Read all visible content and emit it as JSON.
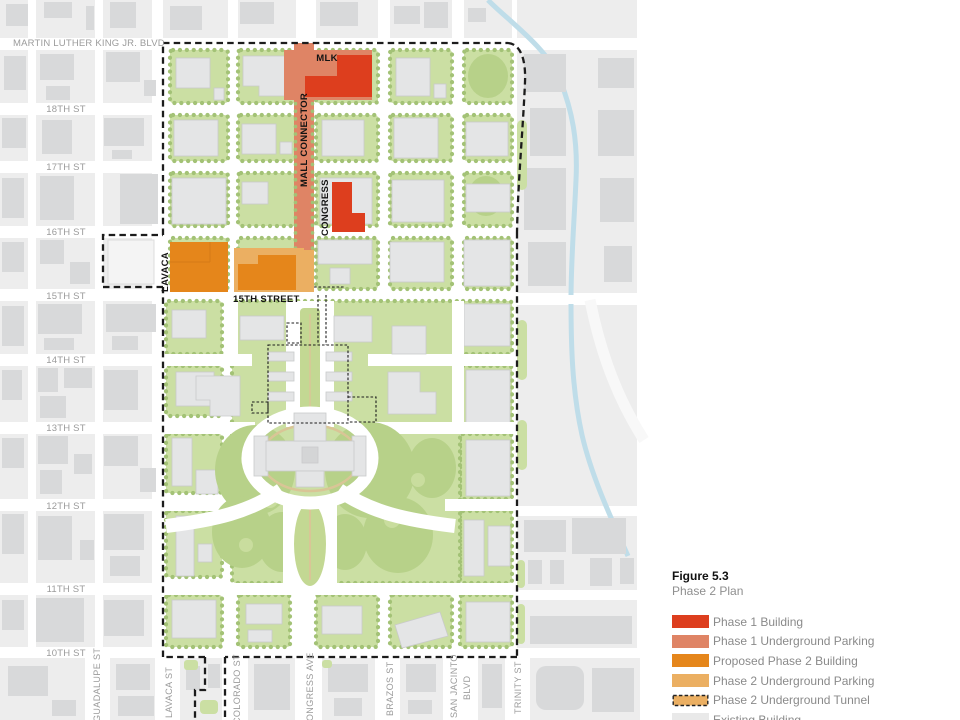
{
  "figure": {
    "number": "Figure 5.3",
    "title": "Phase 2 Plan"
  },
  "legend": {
    "items": [
      {
        "label": "Phase 1 Building",
        "color": "#DD3E1E",
        "swatch": "solid"
      },
      {
        "label": "Phase 1 Underground Parking",
        "color": "#DF8465",
        "swatch": "solid"
      },
      {
        "label": "Proposed Phase 2 Building",
        "color": "#E5861B",
        "swatch": "solid"
      },
      {
        "label": "Phase 2 Underground Parking",
        "color": "#EBAF62",
        "swatch": "solid"
      },
      {
        "label": "Phase 2 Underground Tunnel",
        "color": "#EBAF62",
        "swatch": "dashed-outline"
      },
      {
        "label": "Existing Building",
        "color": "#E9E9E9",
        "swatch": "solid"
      }
    ]
  },
  "map": {
    "horizontal_streets": [
      {
        "label": "MARTIN LUTHER KING JR. BLVD"
      },
      {
        "label": "18TH ST"
      },
      {
        "label": "17TH ST"
      },
      {
        "label": "16TH ST"
      },
      {
        "label": "15TH ST"
      },
      {
        "label": "14TH ST"
      },
      {
        "label": "13TH ST"
      },
      {
        "label": "12TH ST"
      },
      {
        "label": "11TH ST"
      },
      {
        "label": "10TH ST"
      }
    ],
    "vertical_streets": [
      {
        "label": "GUADALUPE ST"
      },
      {
        "label": "LAVACA ST"
      },
      {
        "label": "COLORADO ST"
      },
      {
        "label": "CONGRESS AVE"
      },
      {
        "label": "BRAZOS ST"
      },
      {
        "label": "SAN JACINTO"
      },
      {
        "label": "BLVD"
      },
      {
        "label": "TRINITY ST"
      }
    ],
    "site_labels": {
      "mlk": "MLK",
      "mall_connector": "MALL CONNECTOR",
      "congress": "CONGRESS",
      "lavaca": "LAVACA",
      "fifteenth_street": "15TH STREET"
    }
  },
  "colors": {
    "phase1_building": "#DD3E1E",
    "phase1_parking": "#DF8465",
    "phase2_building": "#E5861B",
    "phase2_parking": "#EBAF62",
    "tunnel": "#EBAF62",
    "existing_building": "#E9E9E9",
    "boundary": "#1C1C1C",
    "creek": "#BFDDE9",
    "green": "#CBDFA3",
    "city_block": "#EDEDED",
    "city_building": "#D8D9DA",
    "street_label": "#9B9B9B",
    "legend_text": "#8A8A8A"
  }
}
